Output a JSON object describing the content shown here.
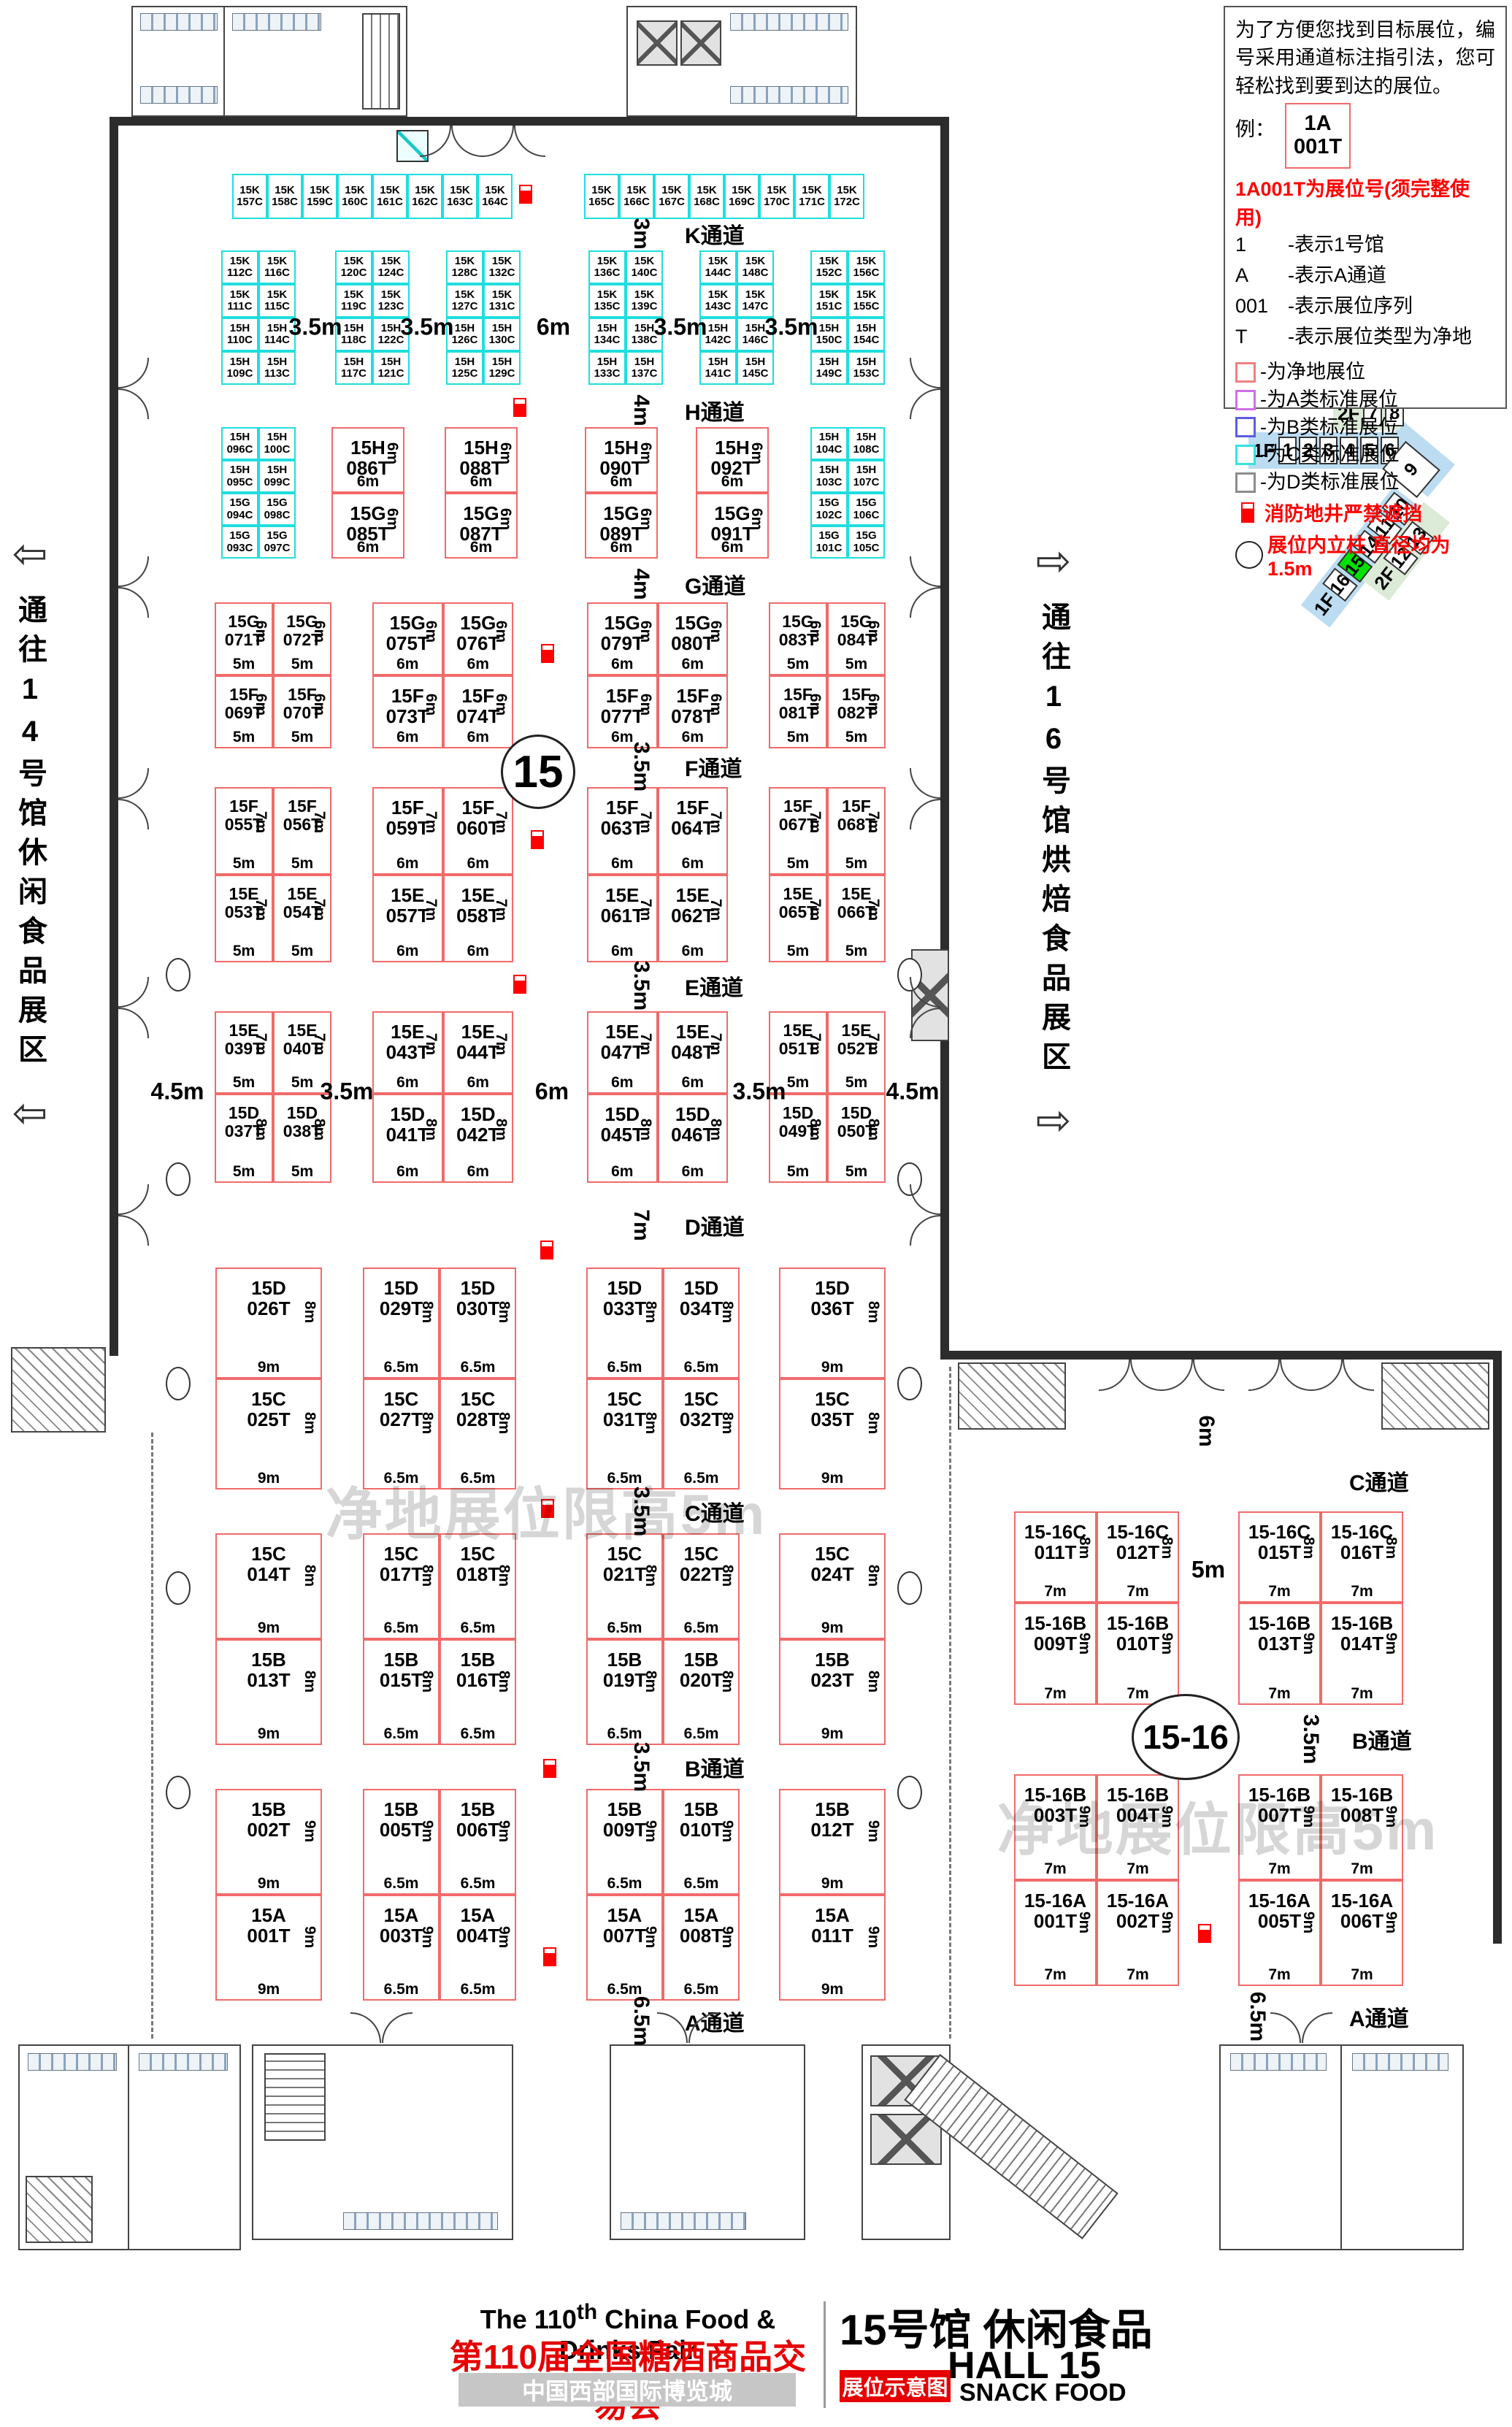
{
  "legend": {
    "intro": "为了方便您找到目标展位，编号采用通道标注指引法，您可轻松找到要到达的展位。",
    "example_prefix": "例：",
    "example_l1": "1A",
    "example_l2": "001T",
    "code_note": "1A001T为展位号(须完整使用)",
    "code_items": [
      [
        "1",
        "-表示1号馆"
      ],
      [
        "A",
        "-表示A通道"
      ],
      [
        "001",
        "-表示展位序列"
      ],
      [
        "T",
        "-表示展位类型为净地"
      ]
    ],
    "type_items": [
      [
        "#f08080",
        "-为净地展位"
      ],
      [
        "#cf6fe8",
        "-为A类标准展位"
      ],
      [
        "#5d5de0",
        "-为B类标准展位"
      ],
      [
        "#35e2e2",
        "-为C类标准展位"
      ],
      [
        "#8d8d8d",
        "-为D类标准展位"
      ]
    ],
    "fire_note": "消防地井严禁遮挡",
    "pillar_note": "展位内立柱 直径均为1.5m"
  },
  "minimap": {
    "f2": "2F",
    "f2_halls": [
      "7",
      "8"
    ],
    "f1": "1F",
    "f1_halls": [
      "1",
      "2",
      "3",
      "4",
      "5",
      "6"
    ],
    "hall9": "9",
    "strip_f1": "1F",
    "strip_halls": [
      "10",
      "11",
      "14",
      "15",
      "16"
    ],
    "green_f2": "2F",
    "green_halls": [
      "12",
      "13"
    ],
    "highlight": "15"
  },
  "side_labels": {
    "left": "通往14号馆休闲食品展区",
    "right": "通往16号馆烘焙食品展区"
  },
  "watermark": "净地展位限高5m",
  "circle_main": "15",
  "circle_annex": "15-16",
  "aisles_main": [
    [
      "3m",
      "K通道"
    ],
    [
      "4m",
      "H通道"
    ],
    [
      "4m",
      "G通道"
    ],
    [
      "3.5m",
      "F通道"
    ],
    [
      "3.5m",
      "E通道"
    ],
    [
      "7m",
      "D通道"
    ],
    [
      "3.5m",
      "C通道"
    ],
    [
      "3.5m",
      "B通道"
    ],
    [
      "6.5m",
      "A通道"
    ]
  ],
  "aisles_annex": [
    [
      "6m",
      "C通道"
    ],
    [
      "3.5m",
      "B通道"
    ],
    [
      "6.5m",
      "A通道"
    ]
  ],
  "annex_gap": "5m",
  "booths": {
    "k_top_left": [
      "15K 157C",
      "15K 158C",
      "15K 159C",
      "15K 160C",
      "15K 161C",
      "15K 162C",
      "15K 163C",
      "15K 164C"
    ],
    "k_top_right": [
      "15K 165C",
      "15K 166C",
      "15K 167C",
      "15K 168C",
      "15K 169C",
      "15K 170C",
      "15K 171C",
      "15K 172C"
    ],
    "kh_blocks": [
      [
        [
          "15K 112C",
          "15K 116C"
        ],
        [
          "15K 111C",
          "15K 115C"
        ],
        [
          "15H 110C",
          "15H 114C"
        ],
        [
          "15H 109C",
          "15H 113C"
        ]
      ],
      [
        [
          "15K 120C",
          "15K 124C"
        ],
        [
          "15K 119C",
          "15K 123C"
        ],
        [
          "15H 118C",
          "15H 122C"
        ],
        [
          "15H 117C",
          "15H 121C"
        ]
      ],
      [
        [
          "15K 128C",
          "15K 132C"
        ],
        [
          "15K 127C",
          "15K 131C"
        ],
        [
          "15H 126C",
          "15H 130C"
        ],
        [
          "15H 125C",
          "15H 129C"
        ]
      ],
      [
        [
          "15K 136C",
          "15K 140C"
        ],
        [
          "15K 135C",
          "15K 139C"
        ],
        [
          "15H 134C",
          "15H 138C"
        ],
        [
          "15H 133C",
          "15H 137C"
        ]
      ],
      [
        [
          "15K 144C",
          "15K 148C"
        ],
        [
          "15K 143C",
          "15K 147C"
        ],
        [
          "15H 142C",
          "15H 146C"
        ],
        [
          "15H 141C",
          "15H 145C"
        ]
      ],
      [
        [
          "15K 152C",
          "15K 156C"
        ],
        [
          "15K 151C",
          "15K 155C"
        ],
        [
          "15H 150C",
          "15H 154C"
        ],
        [
          "15H 149C",
          "15H 153C"
        ]
      ]
    ],
    "kh_gaps": [
      "3.5m",
      "3.5m",
      "6m",
      "3.5m",
      "3.5m"
    ],
    "h_left": [
      [
        "15H 096C",
        "15H 100C"
      ],
      [
        "15H 095C",
        "15H 099C"
      ],
      [
        "15G 094C",
        "15G 098C"
      ],
      [
        "15G 093C",
        "15G 097C"
      ]
    ],
    "h_right": [
      [
        "15H 104C",
        "15H 108C"
      ],
      [
        "15H 103C",
        "15H 107C"
      ],
      [
        "15G 102C",
        "15G 106C"
      ],
      [
        "15G 101C",
        "15G 105C"
      ]
    ],
    "h_pairs": [
      {
        "top": [
          "15H 086T"
        ],
        "bot": [
          "15G 085T"
        ],
        "side": "6m",
        "w": "6m"
      },
      {
        "top": [
          "15H 088T"
        ],
        "bot": [
          "15G 087T"
        ],
        "side": "6m",
        "w": "6m"
      },
      {
        "top": [
          "15H 090T"
        ],
        "bot": [
          "15G 089T"
        ],
        "side": "6m",
        "w": "6m"
      },
      {
        "top": [
          "15H 092T"
        ],
        "bot": [
          "15G 091T"
        ],
        "side": "6m",
        "w": "6m"
      }
    ],
    "gf_blocks": [
      {
        "top": [
          "15G 071T",
          "15G 072T"
        ],
        "bot": [
          "15F 069T",
          "15F 070T"
        ],
        "side": "6m",
        "w": "5m"
      },
      {
        "top": [
          "15G 075T",
          "15G 076T"
        ],
        "bot": [
          "15F 073T",
          "15F 074T"
        ],
        "side": "6m",
        "w": "6m"
      },
      {
        "top": [
          "15G 079T",
          "15G 080T"
        ],
        "bot": [
          "15F 077T",
          "15F 078T"
        ],
        "side": "6m",
        "w": "6m"
      },
      {
        "top": [
          "15G 083T",
          "15G 084T"
        ],
        "bot": [
          "15F 081T",
          "15F 082T"
        ],
        "side": "6m",
        "w": "5m"
      }
    ],
    "fe_blocks": [
      {
        "top": [
          "15F 055T",
          "15F 056T"
        ],
        "bot": [
          "15E 053T",
          "15E 054T"
        ],
        "side": "7m",
        "w": "5m"
      },
      {
        "top": [
          "15F 059T",
          "15F 060T"
        ],
        "bot": [
          "15E 057T",
          "15E 058T"
        ],
        "side": "7m",
        "w": "6m"
      },
      {
        "top": [
          "15F 063T",
          "15F 064T"
        ],
        "bot": [
          "15E 061T",
          "15E 062T"
        ],
        "side": "7m",
        "w": "6m"
      },
      {
        "top": [
          "15F 067T",
          "15F 068T"
        ],
        "bot": [
          "15E 065T",
          "15E 066T"
        ],
        "side": "7m",
        "w": "5m"
      }
    ],
    "ed_blocks": [
      {
        "top": [
          "15E 039T",
          "15E 040T"
        ],
        "bot": [
          "15D 037T",
          "15D 038T"
        ],
        "side": "7m",
        "side2": "8m",
        "w": "5m"
      },
      {
        "top": [
          "15E 043T",
          "15E 044T"
        ],
        "bot": [
          "15D 041T",
          "15D 042T"
        ],
        "side": "7m",
        "side2": "8m",
        "w": "6m"
      },
      {
        "top": [
          "15E 047T",
          "15E 048T"
        ],
        "bot": [
          "15D 045T",
          "15D 046T"
        ],
        "side": "7m",
        "side2": "8m",
        "w": "6m"
      },
      {
        "top": [
          "15E 051T",
          "15E 052T"
        ],
        "bot": [
          "15D 049T",
          "15D 050T"
        ],
        "side": "7m",
        "side2": "8m",
        "w": "5m"
      }
    ],
    "ed_gaps": [
      "4.5m",
      "3.5m",
      "6m",
      "3.5m",
      "4.5m"
    ],
    "dc_blocks": [
      {
        "top": [
          "15D 026T"
        ],
        "bot": [
          "15C 025T"
        ],
        "side": "8m",
        "w": "9m"
      },
      {
        "top": [
          "15D 029T",
          "15D 030T"
        ],
        "bot": [
          "15C 027T",
          "15C 028T"
        ],
        "side": "8m",
        "w": "6.5m"
      },
      {
        "top": [
          "15D 033T",
          "15D 034T"
        ],
        "bot": [
          "15C 031T",
          "15C 032T"
        ],
        "side": "8m",
        "w": "6.5m"
      },
      {
        "top": [
          "15D 036T"
        ],
        "bot": [
          "15C 035T"
        ],
        "side": "8m",
        "w": "9m"
      }
    ],
    "cb_blocks": [
      {
        "top": [
          "15C 014T"
        ],
        "bot": [
          "15B 013T"
        ],
        "side": "8m",
        "w": "9m"
      },
      {
        "top": [
          "15C 017T",
          "15C 018T"
        ],
        "bot": [
          "15B 015T",
          "15B 016T"
        ],
        "side": "8m",
        "w": "6.5m"
      },
      {
        "top": [
          "15C 021T",
          "15C 022T"
        ],
        "bot": [
          "15B 019T",
          "15B 020T"
        ],
        "side": "8m",
        "w": "6.5m"
      },
      {
        "top": [
          "15C 024T"
        ],
        "bot": [
          "15B 023T"
        ],
        "side": "8m",
        "w": "9m"
      }
    ],
    "ba_blocks": [
      {
        "top": [
          "15B 002T"
        ],
        "bot": [
          "15A 001T"
        ],
        "side": "9m",
        "w": "9m"
      },
      {
        "top": [
          "15B 005T",
          "15B 006T"
        ],
        "bot": [
          "15A 003T",
          "15A 004T"
        ],
        "side": "9m",
        "w": "6.5m"
      },
      {
        "top": [
          "15B 009T",
          "15B 010T"
        ],
        "bot": [
          "15A 007T",
          "15A 008T"
        ],
        "side": "9m",
        "w": "6.5m"
      },
      {
        "top": [
          "15B 012T"
        ],
        "bot": [
          "15A 011T"
        ],
        "side": "9m",
        "w": "9m"
      }
    ],
    "annex_cb": [
      {
        "top": [
          "15-16C 011T",
          "15-16C 012T"
        ],
        "bot": [
          "15-16B 009T",
          "15-16B 010T"
        ],
        "side": "8m",
        "side2": "9m",
        "w": "7m"
      },
      {
        "top": [
          "15-16C 015T",
          "15-16C 016T"
        ],
        "bot": [
          "15-16B 013T",
          "15-16B 014T"
        ],
        "side": "8m",
        "side2": "9m",
        "w": "7m"
      }
    ],
    "annex_ba": [
      {
        "top": [
          "15-16B 003T",
          "15-16B 004T"
        ],
        "bot": [
          "15-16A 001T",
          "15-16A 002T"
        ],
        "side": "9m",
        "side2": "9m",
        "w": "7m"
      },
      {
        "top": [
          "15-16B 007T",
          "15-16B 008T"
        ],
        "bot": [
          "15-16A 005T",
          "15-16A 006T"
        ],
        "side": "9m",
        "side2": "9m",
        "w": "7m"
      }
    ]
  },
  "title": {
    "en_pre": "The 110",
    "en_sup": "th",
    "en_post": " China Food & Drinks Fair",
    "cn": "第110届全国糖酒商品交易会",
    "venue": "中国西部国际博览城",
    "hall_cn": "15号馆 休闲食品",
    "hall_en": "HALL 15",
    "tag": "展位示意图",
    "hall_sub": "SNACK FOOD"
  }
}
